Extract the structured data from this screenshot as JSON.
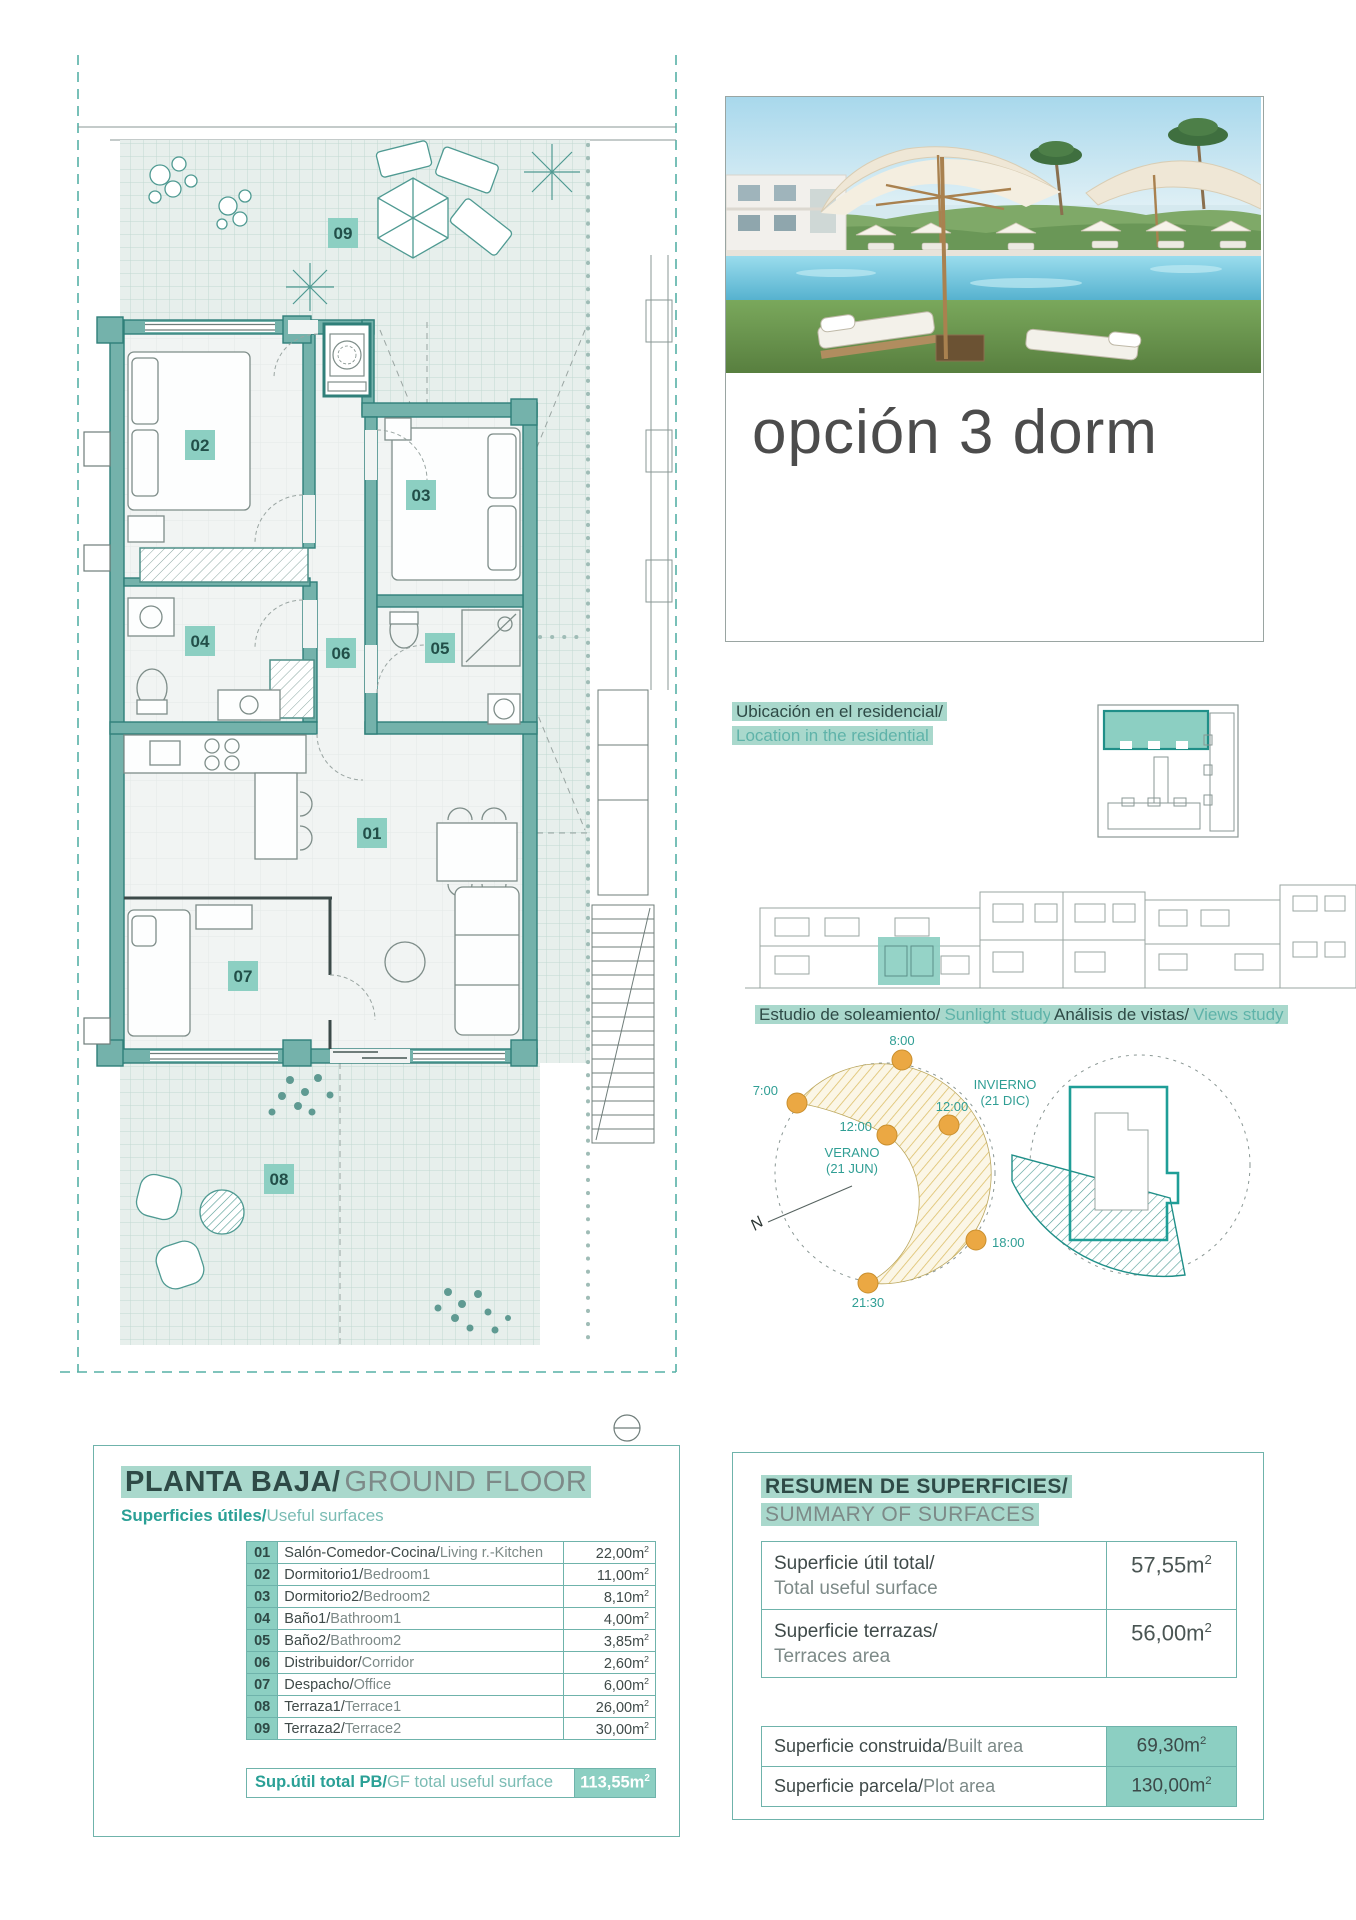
{
  "header": {
    "title": "opción 3 dorm"
  },
  "location": {
    "es": "Ubicación en el residencial/",
    "en": "Location in the residential"
  },
  "sun_study": {
    "label_es": "Estudio de soleamiento/",
    "label_en": "Sunlight study",
    "times": {
      "t7": "7:00",
      "t8": "8:00",
      "noon_summer": "12:00",
      "noon_winter": "12:00",
      "t18": "18:00",
      "t2130": "21:30"
    },
    "summer": [
      "VERANO",
      "(21 JUN)"
    ],
    "winter": [
      "INVIERNO",
      "(21 DIC)"
    ],
    "north": "N"
  },
  "views_study": {
    "label_es": "Análisis de vistas/",
    "label_en": "Views study"
  },
  "plan": {
    "badges": {
      "b01": "01",
      "b02": "02",
      "b03": "03",
      "b04": "04",
      "b05": "05",
      "b06": "06",
      "b07": "07",
      "b08": "08",
      "b09": "09"
    }
  },
  "ground_floor": {
    "title_es": "PLANTA BAJA/",
    "title_en": "GROUND FLOOR",
    "subtitle_es": "Superficies útiles/",
    "subtitle_en": "Useful surfaces",
    "rooms": [
      {
        "num": "01",
        "name_es": "Salón-Comedor-Cocina/",
        "name_en": "Living r.-Kitchen",
        "area": "22,00m",
        "sup": "2"
      },
      {
        "num": "02",
        "name_es": "Dormitorio1/",
        "name_en": "Bedroom1",
        "area": "11,00m",
        "sup": "2"
      },
      {
        "num": "03",
        "name_es": "Dormitorio2/",
        "name_en": "Bedroom2",
        "area": "8,10m",
        "sup": "2"
      },
      {
        "num": "04",
        "name_es": "Baño1/",
        "name_en": "Bathroom1",
        "area": "4,00m",
        "sup": "2"
      },
      {
        "num": "05",
        "name_es": "Baño2/",
        "name_en": "Bathroom2",
        "area": "3,85m",
        "sup": "2"
      },
      {
        "num": "06",
        "name_es": "Distribuidor/",
        "name_en": "Corridor",
        "area": "2,60m",
        "sup": "2"
      },
      {
        "num": "07",
        "name_es": "Despacho/",
        "name_en": "Office",
        "area": "6,00m",
        "sup": "2"
      },
      {
        "num": "08",
        "name_es": "Terraza1/",
        "name_en": "Terrace1",
        "area": "26,00m",
        "sup": "2"
      },
      {
        "num": "09",
        "name_es": "Terraza2/",
        "name_en": "Terrace2",
        "area": "30,00m",
        "sup": "2"
      }
    ],
    "total_label_es": "Sup.útil total PB/",
    "total_label_en": "GF total useful surface",
    "total_area": "113,55m",
    "total_sup": "2"
  },
  "summary": {
    "title_es": "RESUMEN DE SUPERFICIES/",
    "title_en": "SUMMARY OF SURFACES",
    "rows": [
      {
        "label_es": "Superficie útil total/",
        "label_en": "Total useful surface",
        "value": "57,55m",
        "sup": "2"
      },
      {
        "label_es": "Superficie terrazas/",
        "label_en": "Terraces area",
        "value": "56,00m",
        "sup": "2"
      }
    ],
    "built_rows": [
      {
        "label_es": "Superficie construida/",
        "label_en": "Built area",
        "value": "69,30m",
        "sup": "2"
      },
      {
        "label_es": "Superficie parcela/",
        "label_en": "Plot area",
        "value": "130,00m",
        "sup": "2"
      }
    ]
  },
  "colors": {
    "accent_teal": "#2aa096",
    "mint_highlight": "#a9d8cc",
    "wall_teal": "#74b2ab",
    "badge_mint": "#8ccfc2",
    "sun_orange": "#eba843",
    "dark_text": "#37413f",
    "gray_text": "#7d8a88"
  }
}
